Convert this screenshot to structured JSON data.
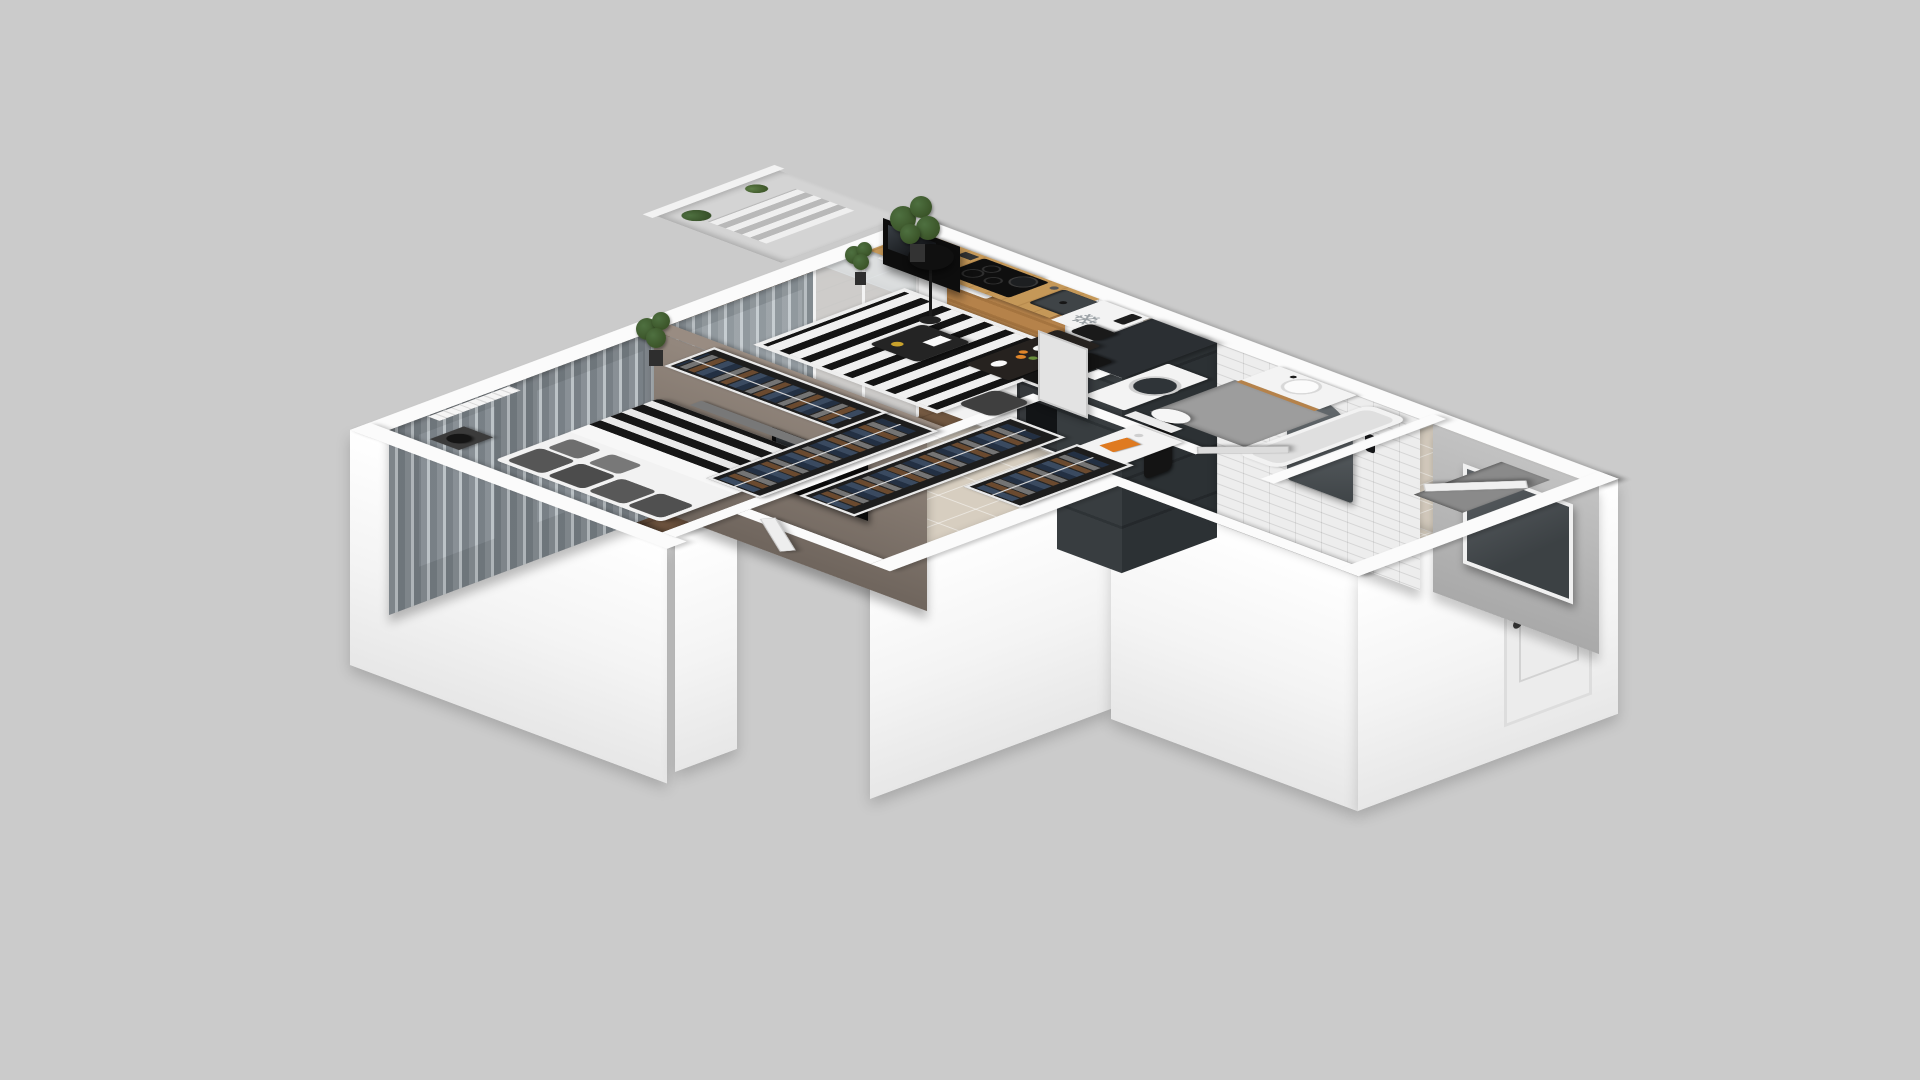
{
  "scene": {
    "kind": "isometric-3d-apartment-floorplan-render",
    "background_is_plain_grey": true,
    "visible_text": "none"
  },
  "icons": {
    "snowflake": "❄"
  },
  "palette": {
    "bg": "#cbcbcb",
    "wallTop": "#fbfbfb",
    "wallBand": "#f4f4f4",
    "wallFaceGrey": "#e4e4e4",
    "taupeWall": "#998c82",
    "curtainDark": "#7d848a",
    "curtainLight": "#b8bfc3",
    "windowGlass": "#ccd3d7",
    "woodFloorBedroom": "#7c5e46",
    "woodFloorLiving": "#8a6a4e",
    "tileBeige": "#d7cec0",
    "bathFloor": "#ebebeb",
    "bathMat": "#9d9d9d",
    "darkTile": "#2b2f33",
    "subwayTile": "#ededed",
    "cabinetWhite": "#f2f2f2",
    "woodAccent": "#b5824a",
    "counterWood": "#c59858",
    "applianceDark": "#111111",
    "rugBlack": "#141414",
    "rugWhite": "#f0f0f0",
    "mattress": "#f2f2f2",
    "pillowGrey": "#565656",
    "clothesNavy": "#3a4a60",
    "clothesBrown": "#6b4a2f",
    "clothesGrey": "#747474",
    "furnitureWhite": "#f3f3f3",
    "chairBlack": "#141414",
    "plantGreen": "#4e7040",
    "accentOrange": "#df7a20",
    "mirrorDark": "#515659",
    "doorGrey": "#dcdcdc",
    "ice": "#9aa0a4"
  },
  "rooms": [
    {
      "name": "bedroom",
      "items": [
        "double-bed",
        "grey-pillows",
        "striped-blanket",
        "nightstand",
        "black-table-lamp",
        "radiator",
        "grey-curtains",
        "windows",
        "open-wardrobe-clothes-south",
        "open-wardrobe-clothes-east",
        "bench",
        "potted-plant",
        "wall-tv-on-taupe-partition"
      ]
    },
    {
      "name": "living-room",
      "items": [
        "black-white-striped-rug",
        "coffee-table",
        "gold-vase",
        "light-armchair",
        "dark-armchair",
        "black-floor-lamp",
        "white-tv-console",
        "flat-tv",
        "sheer-curtains",
        "balcony-door",
        "potted-plants",
        "interior-door"
      ]
    },
    {
      "name": "kitchen",
      "items": [
        "white-cabinets",
        "oak-accent-upper-cabinet",
        "wood-countertop",
        "induction-cooktop",
        "pans",
        "oven",
        "sink",
        "faucet",
        "kettle",
        "knife-block",
        "fridge-with-snowflake-symbol",
        "small-black-appliance",
        "dining-table",
        "white-plates",
        "oranges",
        "black-chairs"
      ]
    },
    {
      "name": "bathroom",
      "items": [
        "white-subway-tile-walls",
        "dark-tile-column",
        "washing-machine-under-counter",
        "wall-hung-toilet",
        "vanity-with-drawers",
        "vessel-basin",
        "arched-mirror",
        "black-sconces",
        "black-towel",
        "grey-wet-mat",
        "bathtub",
        "grey-door-open"
      ]
    },
    {
      "name": "hallway",
      "items": [
        "open-wardrobe-rail-1",
        "open-wardrobe-rail-2",
        "hanging-clothes",
        "beige-tile-floor",
        "bedroom-door"
      ]
    },
    {
      "name": "entry",
      "items": [
        "white-sideboard",
        "orange-book",
        "grey-accent-wall",
        "dark-mirror-panel",
        "front-door",
        "dark-doormat"
      ]
    },
    {
      "name": "balcony",
      "items": [
        "white-railing",
        "striped-mat",
        "potted-plants"
      ]
    }
  ]
}
